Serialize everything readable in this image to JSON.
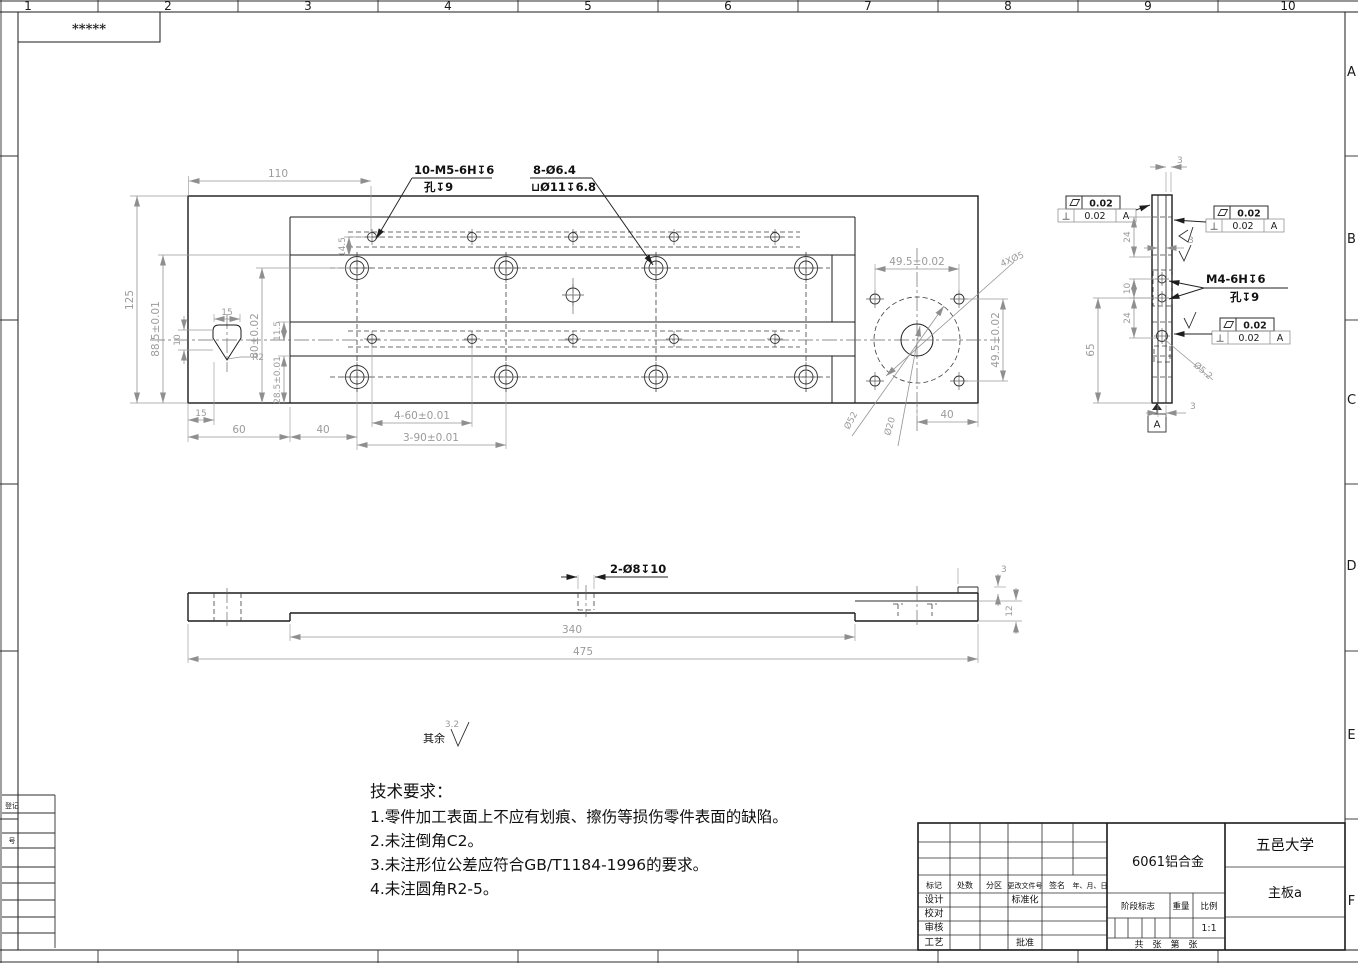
{
  "sheet": {
    "stars": "*****",
    "cols": [
      "1",
      "2",
      "3",
      "4",
      "5",
      "6",
      "7",
      "8",
      "9",
      "10"
    ],
    "rows": [
      "A",
      "B",
      "C",
      "D",
      "E",
      "F"
    ],
    "margin": {
      "l1": "登记",
      "l2": "号"
    }
  },
  "top_view": {
    "labels": {
      "m5": "10-M5-6H↧6",
      "m5_sub": "孔↧9",
      "cbore": "8-Ø6.4",
      "cbore_sub": "⊔Ø11↧6.8",
      "pattern": "4XØ5",
      "d52": "Ø52",
      "d20": "Ø20",
      "r2": "R2"
    },
    "dims": {
      "w110": "110",
      "h125": "125",
      "h885": "88.5±0.01",
      "h80": "80±0.02",
      "h115": "11.5",
      "h285": "28.5±0.01",
      "h10": "10",
      "w15p": "15",
      "w15": "15",
      "w60": "60",
      "w40": "40",
      "h145": "14.5",
      "p460": "4-60±0.01",
      "p390": "3-90±0.01",
      "p495h": "49.5±0.02",
      "p495v": "49.5±0.02",
      "w40r": "40"
    }
  },
  "side_view": {
    "labels": {
      "m4": "M4-6H↧6",
      "m4_sub": "孔↧9",
      "d52": "Ø5.2",
      "datum": "A"
    },
    "dims": {
      "t3": "3",
      "d24a": "24",
      "d10": "10",
      "d24b": "24",
      "h65": "65",
      "m3": "3",
      "b3": "3"
    },
    "fcf": {
      "flat": "0.02",
      "perp": "0.02",
      "datum": "A"
    }
  },
  "bottom_view": {
    "labels": {
      "holes": "2-Ø8↧10"
    },
    "dims": {
      "l340": "340",
      "l475": "475",
      "s3": "3",
      "t12": "12"
    }
  },
  "finish": {
    "prefix": "其余",
    "ra": "3.2"
  },
  "tech": {
    "title": "技术要求：",
    "items": [
      "1.零件加工表面上不应有划痕、擦伤等损伤零件表面的缺陷。",
      "2.未注倒角C2。",
      "3.未注形位公差应符合GB/T1184-1996的要求。",
      "4.未注圆角R2-5。"
    ]
  },
  "title_block": {
    "material": "6061铝合金",
    "org": "五邑大学",
    "part": "主板a",
    "scale_value": "1:1",
    "rev_cols": [
      "标记",
      "处数",
      "分区",
      "更改文件号",
      "签名",
      "年、月、日"
    ],
    "rows": [
      "设计",
      "校对",
      "审核",
      "工艺"
    ],
    "std": "标准化",
    "approve": "批准",
    "stage": "阶段标志",
    "weight": "重量",
    "scale": "比例",
    "sheets": "共　张　第　张"
  }
}
